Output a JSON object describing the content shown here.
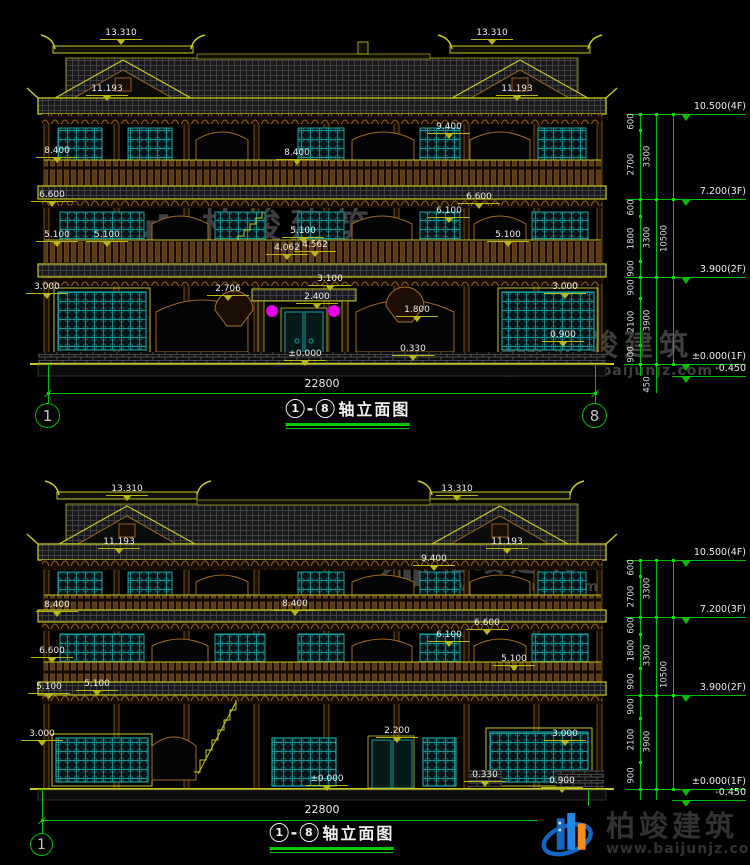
{
  "watermark": {
    "brand": "柏竣建筑",
    "site": "www.baijunjz.com"
  },
  "footer_logo": {
    "brand": "柏竣建筑",
    "site": "www.baijunjz.com"
  },
  "colors": {
    "line_yellow": "#c8c81e",
    "dim_green": "#00c000",
    "lattice_teal": "#18a0a0",
    "bracket_brown": "#a06a24",
    "lantern_magenta": "#e800e8",
    "text": "#ededed"
  },
  "drawings": [
    {
      "name": "front-elevation",
      "title": {
        "axis_from": "1",
        "axis_to": "8",
        "suffix": "轴立面图"
      },
      "overall_width_label": "22800",
      "dim_line": {
        "x1": 48,
        "x2": 595,
        "y": 393,
        "tx": 322,
        "ty": 377
      },
      "stem_y1": 364,
      "axis_bubbles": [
        {
          "n": "1",
          "x": 48,
          "y": 416,
          "r": 13
        },
        {
          "n": "8",
          "x": 595,
          "y": 416,
          "r": 13
        }
      ],
      "labels": [
        {
          "t": "13.310",
          "x": 121,
          "y": 28
        },
        {
          "t": "13.310",
          "x": 492,
          "y": 28
        },
        {
          "t": "11.193",
          "x": 107,
          "y": 84
        },
        {
          "t": "11.193",
          "x": 517,
          "y": 84
        },
        {
          "t": "9.400",
          "x": 449,
          "y": 122
        },
        {
          "t": "8.400",
          "x": 57,
          "y": 146
        },
        {
          "t": "8.400",
          "x": 297,
          "y": 148
        },
        {
          "t": "6.600",
          "x": 52,
          "y": 190
        },
        {
          "t": "6.600",
          "x": 479,
          "y": 192
        },
        {
          "t": "6.100",
          "x": 449,
          "y": 206
        },
        {
          "t": "5.100",
          "x": 57,
          "y": 230
        },
        {
          "t": "5.100",
          "x": 107,
          "y": 230
        },
        {
          "t": "5.100",
          "x": 303,
          "y": 226
        },
        {
          "t": "5.100",
          "x": 508,
          "y": 230
        },
        {
          "t": "4.062",
          "x": 287,
          "y": 243
        },
        {
          "t": "4.562",
          "x": 315,
          "y": 240
        },
        {
          "t": "3.100",
          "x": 330,
          "y": 274
        },
        {
          "t": "2.706",
          "x": 228,
          "y": 284
        },
        {
          "t": "2.400",
          "x": 317,
          "y": 292
        },
        {
          "t": "3.000",
          "x": 47,
          "y": 282
        },
        {
          "t": "3.000",
          "x": 565,
          "y": 282
        },
        {
          "t": "1.800",
          "x": 417,
          "y": 305
        },
        {
          "t": "0.900",
          "x": 563,
          "y": 330
        },
        {
          "t": "0.330",
          "x": 413,
          "y": 344
        },
        {
          "t": "±0.000",
          "x": 305,
          "y": 349
        }
      ],
      "chain": {
        "x_seg": 640,
        "x_mid": 656,
        "x_tot": 673,
        "levels": [
          {
            "text": "10.500(4F)",
            "y": 114
          },
          {
            "text": "7.200(3F)",
            "y": 199
          },
          {
            "text": "3.900(2F)",
            "y": 277
          },
          {
            "text": "±0.000(1F)",
            "y": 364
          },
          {
            "text": "-0.450",
            "y": 376,
            "short": true
          }
        ],
        "segments": [
          {
            "text": "600",
            "y1": 114,
            "y2": 130
          },
          {
            "text": "2700",
            "y1": 130,
            "y2": 199
          },
          {
            "text": "600",
            "y1": 199,
            "y2": 216
          },
          {
            "text": "1800",
            "y1": 216,
            "y2": 261
          },
          {
            "text": "900",
            "y1": 261,
            "y2": 277
          },
          {
            "text": "900",
            "y1": 277,
            "y2": 298
          },
          {
            "text": "2100",
            "y1": 298,
            "y2": 345
          },
          {
            "text": "900",
            "y1": 345,
            "y2": 364
          }
        ],
        "mids": [
          {
            "text": "3300",
            "y1": 114,
            "y2": 199
          },
          {
            "text": "3300",
            "y1": 199,
            "y2": 277
          },
          {
            "text": "3900",
            "y1": 277,
            "y2": 364
          }
        ],
        "total": {
          "text": "10500",
          "y1": 114,
          "y2": 364
        },
        "base": {
          "text": "450",
          "y1": 376,
          "y2": 393
        }
      }
    },
    {
      "name": "back-elevation",
      "title": {
        "axis_from": "1",
        "axis_to": "8",
        "suffix": "轴立面图"
      },
      "overall_width_label": "22800",
      "dim_line": {
        "x1": 42,
        "x2": 588,
        "y": 820,
        "tx": 322,
        "ty": 803
      },
      "stem_y1": 789,
      "axis_bubbles": [
        {
          "n": "1",
          "x": 42,
          "y": 845,
          "r": 12
        },
        {
          "n": "8",
          "x": 588,
          "y": 845,
          "r": 12
        }
      ],
      "labels": [
        {
          "t": "13.310",
          "x": 127,
          "y": 484
        },
        {
          "t": "13.310",
          "x": 457,
          "y": 484
        },
        {
          "t": "11.193",
          "x": 119,
          "y": 537
        },
        {
          "t": "11.193",
          "x": 507,
          "y": 537
        },
        {
          "t": "9.400",
          "x": 434,
          "y": 554
        },
        {
          "t": "8.400",
          "x": 57,
          "y": 600
        },
        {
          "t": "8.400",
          "x": 295,
          "y": 599
        },
        {
          "t": "6.600",
          "x": 52,
          "y": 646
        },
        {
          "t": "6.600",
          "x": 487,
          "y": 618
        },
        {
          "t": "6.100",
          "x": 449,
          "y": 630
        },
        {
          "t": "5.100",
          "x": 97,
          "y": 679
        },
        {
          "t": "5.100",
          "x": 49,
          "y": 682
        },
        {
          "t": "5.100",
          "x": 514,
          "y": 654
        },
        {
          "t": "3.000",
          "x": 42,
          "y": 729
        },
        {
          "t": "3.000",
          "x": 565,
          "y": 729
        },
        {
          "t": "2.200",
          "x": 397,
          "y": 726
        },
        {
          "t": "0.330",
          "x": 485,
          "y": 770
        },
        {
          "t": "0.900",
          "x": 562,
          "y": 776
        },
        {
          "t": "±0.000",
          "x": 327,
          "y": 774
        }
      ],
      "chain": {
        "x_seg": 640,
        "x_mid": 656,
        "x_tot": 673,
        "levels": [
          {
            "text": "10.500(4F)",
            "y": 560
          },
          {
            "text": "7.200(3F)",
            "y": 617
          },
          {
            "text": "3.900(2F)",
            "y": 695
          },
          {
            "text": "±0.000(1F)",
            "y": 789
          },
          {
            "text": "-0.450",
            "y": 800,
            "short": true
          }
        ],
        "segments": [
          {
            "text": "600",
            "y1": 560,
            "y2": 576
          },
          {
            "text": "2700",
            "y1": 576,
            "y2": 617
          },
          {
            "text": "600",
            "y1": 617,
            "y2": 634
          },
          {
            "text": "1800",
            "y1": 634,
            "y2": 668
          },
          {
            "text": "900",
            "y1": 668,
            "y2": 695
          },
          {
            "text": "900",
            "y1": 695,
            "y2": 718
          },
          {
            "text": "2100",
            "y1": 718,
            "y2": 762
          },
          {
            "text": "900",
            "y1": 762,
            "y2": 789
          }
        ],
        "mids": [
          {
            "text": "3300",
            "y1": 560,
            "y2": 617
          },
          {
            "text": "3300",
            "y1": 617,
            "y2": 695
          },
          {
            "text": "3900",
            "y1": 695,
            "y2": 789
          }
        ],
        "total": {
          "text": "10500",
          "y1": 560,
          "y2": 789
        }
      }
    }
  ]
}
